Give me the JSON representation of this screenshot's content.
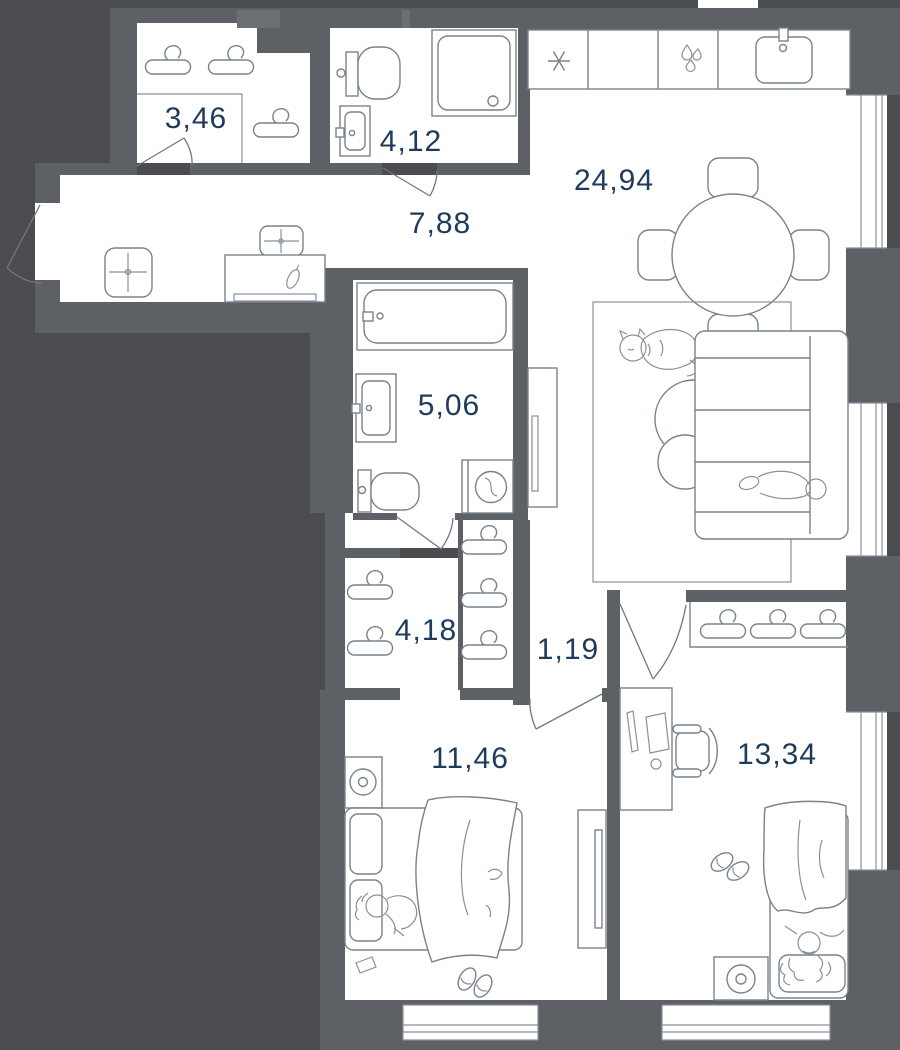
{
  "plan": {
    "title": "apartment-floor-plan",
    "units": "m2-areas-with-comma-decimal",
    "colors": {
      "background": "#4b4c50",
      "wall": "#5d6064",
      "room_fill": "#ffffff",
      "furniture_line": "#7a828b",
      "label_text": "#1e3a5c"
    },
    "rooms": [
      {
        "id": "hall-wardrobe",
        "area": "3,46"
      },
      {
        "id": "bathroom-small",
        "area": "4,12"
      },
      {
        "id": "hallway",
        "area": "7,88"
      },
      {
        "id": "kitchen-living",
        "area": "24,94"
      },
      {
        "id": "bathroom-main",
        "area": "5,06"
      },
      {
        "id": "wardrobe",
        "area": "4,18"
      },
      {
        "id": "corridor",
        "area": "1,19"
      },
      {
        "id": "bedroom-1",
        "area": "11,46"
      },
      {
        "id": "bedroom-2",
        "area": "13,34"
      }
    ],
    "icons": [
      "hanger-icon",
      "stove-asterisk-icon",
      "water-drops-icon",
      "kitchen-sink-icon",
      "shower-icon",
      "toilet-icon",
      "washbasin-icon",
      "bathtub-icon",
      "washing-machine-icon",
      "dining-table-icon",
      "chair-icon",
      "sofa-icon",
      "rug-icon",
      "cat-icon",
      "coffee-table-icon",
      "bed-icon",
      "pillow-icon",
      "person-icon",
      "slippers-icon",
      "tv-icon",
      "desk-icon",
      "office-chair-icon",
      "nightstand-lamp-icon",
      "pouf-icon",
      "console-table-icon",
      "door-swing-icon",
      "window-icon"
    ]
  }
}
